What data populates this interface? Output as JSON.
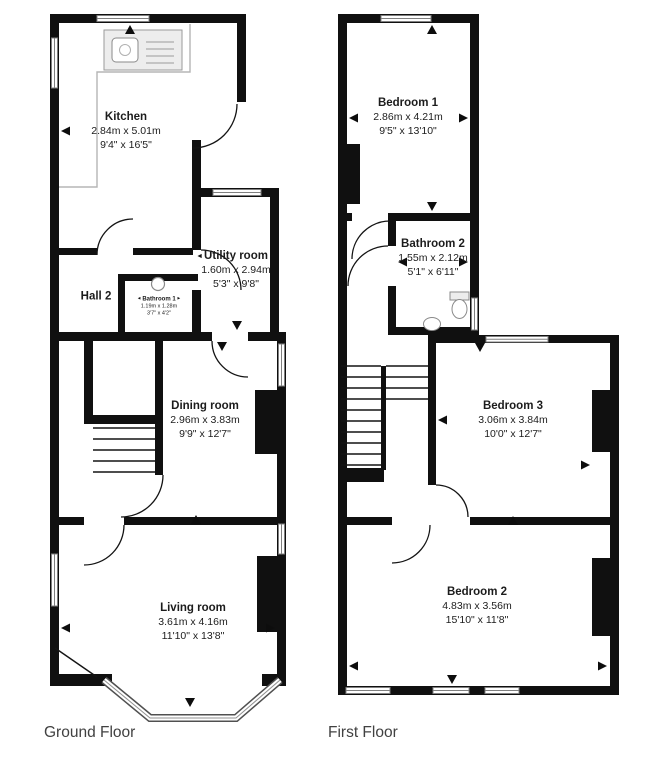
{
  "icons": {
    "arrow_up": "▲",
    "arrow_down": "▼",
    "arrow_left": "◄",
    "arrow_right": "►"
  },
  "colors": {
    "wall": "#101010",
    "window_frame": "#808080",
    "text": "#1c1c1c",
    "caption": "#414141"
  },
  "ground_floor": {
    "caption": "Ground Floor",
    "rooms": {
      "kitchen": {
        "name": "Kitchen",
        "metric": "2.84m x 5.01m",
        "imperial": "9'4\" x 16'5\""
      },
      "utility": {
        "name": "Utility room",
        "metric": "1.60m x 2.94m",
        "imperial": "5'3\" x 9'8\""
      },
      "hall": {
        "name": "Hall 2"
      },
      "bathroom1": {
        "name": "Bathroom 1",
        "metric": "1.19m x 1.28m",
        "imperial": "3'7\" x 4'2\""
      },
      "dining": {
        "name": "Dining room",
        "metric": "2.96m x 3.83m",
        "imperial": "9'9\" x 12'7\""
      },
      "living": {
        "name": "Living room",
        "metric": "3.61m x 4.16m",
        "imperial": "11'10\" x 13'8\""
      }
    }
  },
  "first_floor": {
    "caption": "First Floor",
    "rooms": {
      "bedroom1": {
        "name": "Bedroom 1",
        "metric": "2.86m x 4.21m",
        "imperial": "9'5\" x 13'10\""
      },
      "bathroom2": {
        "name": "Bathroom 2",
        "metric": "1.55m x 2.12m",
        "imperial": "5'1\" x 6'11\""
      },
      "bedroom3": {
        "name": "Bedroom 3",
        "metric": "3.06m x 3.84m",
        "imperial": "10'0\" x 12'7\""
      },
      "bedroom2": {
        "name": "Bedroom 2",
        "metric": "4.83m x 3.56m",
        "imperial": "15'10\" x 11'8\""
      }
    }
  }
}
